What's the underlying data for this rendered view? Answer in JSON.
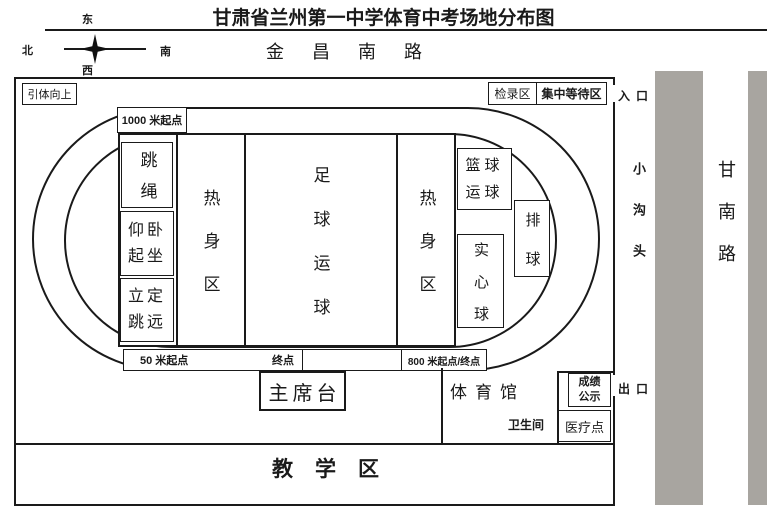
{
  "title": "甘肃省兰州第一中学体育中考场地分布图",
  "compass": {
    "up": "东",
    "left": "北",
    "right": "南",
    "down": "西"
  },
  "roads": {
    "top": "金昌南路",
    "side_lane": "小沟头",
    "side_road": "甘南路"
  },
  "gates": {
    "entrance": "入口",
    "exit": "出口"
  },
  "top_boxes": {
    "pull_up": "引体向上",
    "check_in": "检录区",
    "waiting": "集中等待区"
  },
  "track": {
    "start_1000m": "1000 米起点",
    "start_50m": "50 米起点",
    "finish": "终点",
    "start_800m": "800 米起点/终点"
  },
  "infield": {
    "rope_skipping": "跳绳",
    "sit_ups": {
      "lines": [
        "仰卧",
        "起坐"
      ]
    },
    "standing_jump": {
      "lines": [
        "立定",
        "跳远"
      ]
    },
    "warm_up_left": "热身区",
    "football_dribble": "足球运球",
    "warm_up_right": "热身区",
    "basketball_dribble": {
      "lines": [
        "篮球",
        "运球"
      ]
    },
    "volleyball": "排球",
    "medicine_ball": "实心球"
  },
  "south_area": {
    "rostrum": "主席台",
    "gymnasium": "体育馆",
    "score_notice": {
      "lines": [
        "成绩",
        "公示"
      ]
    },
    "restroom": "卫生间",
    "medical_point": "医疗点",
    "teaching_area": "教学区"
  },
  "colors": {
    "road_bar": "#a8a5a0",
    "line": "#1a1a1a"
  }
}
